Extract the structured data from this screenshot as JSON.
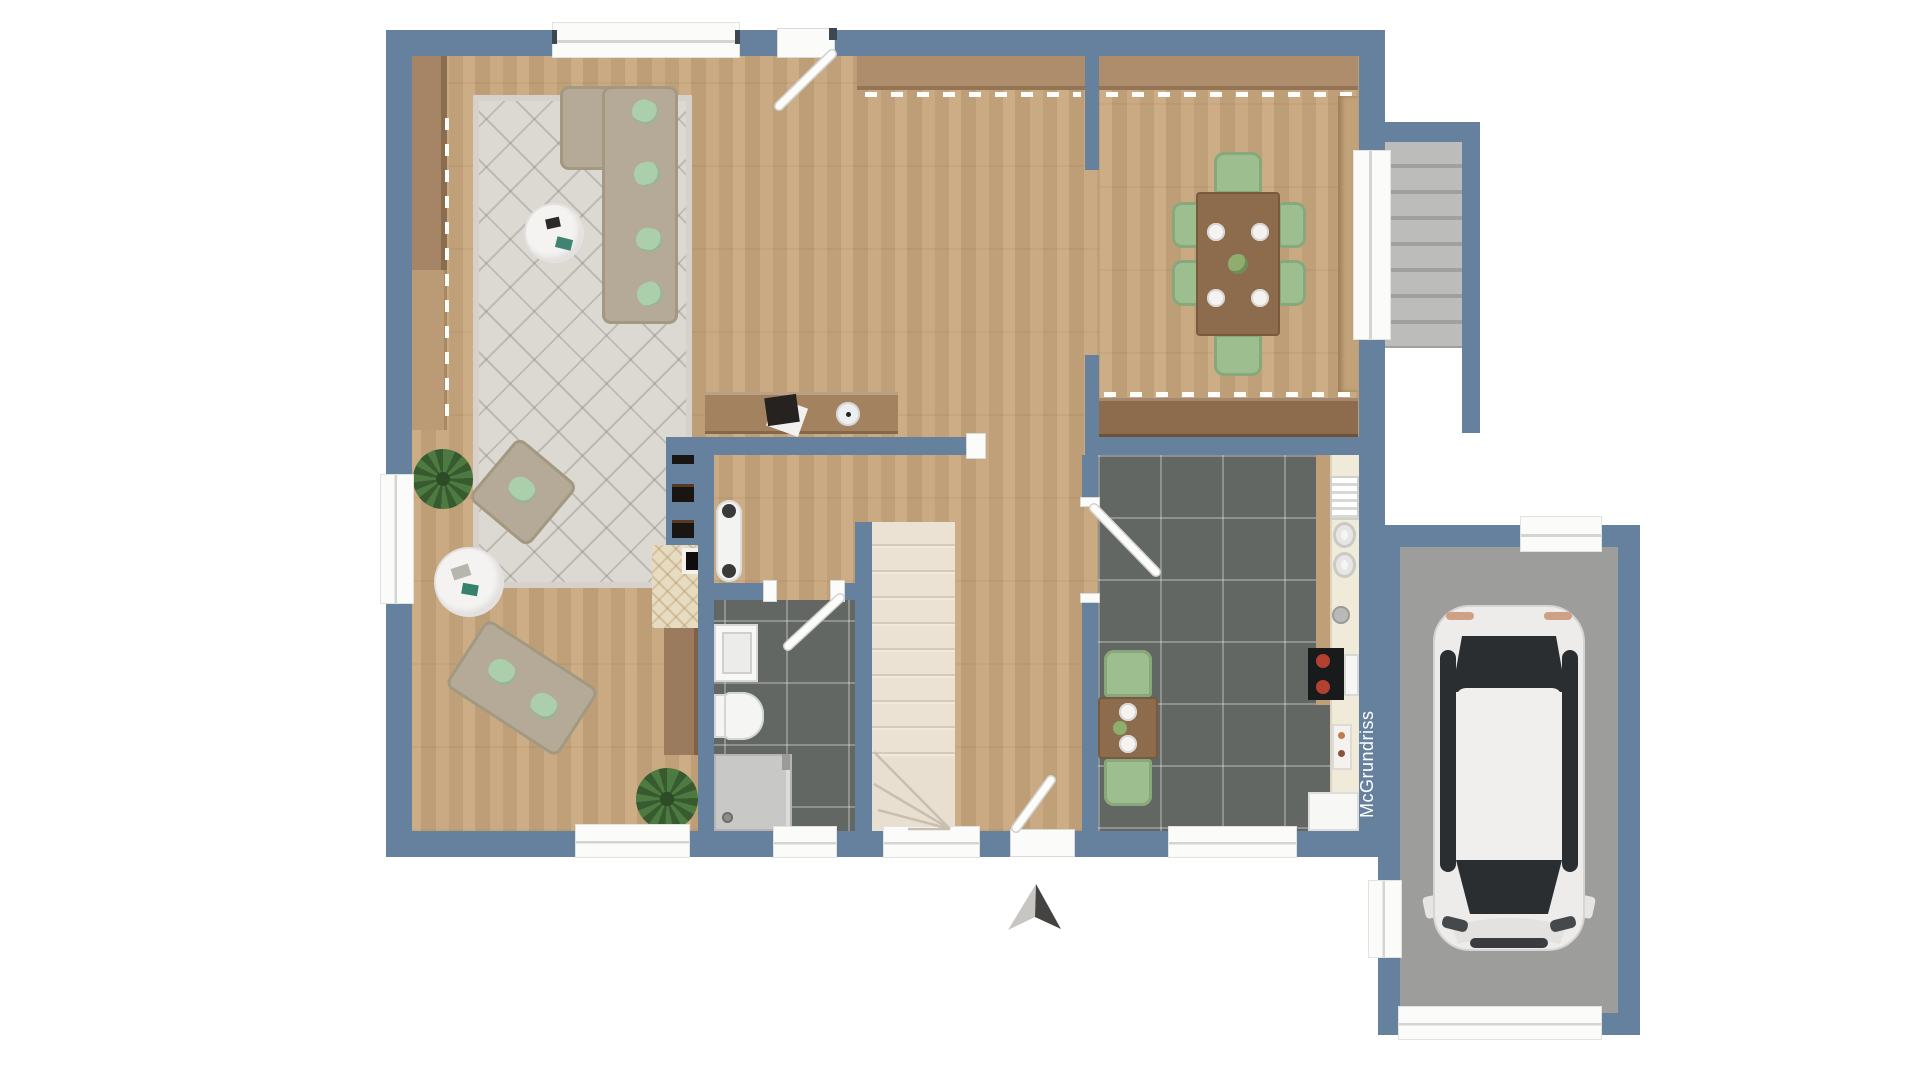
{
  "floorplan": {
    "watermark": "McGrundriss",
    "icons": {
      "north_arrow": "two-tone arrowhead pointing up"
    },
    "palette": {
      "wall": "#66819d",
      "wood": "#c8a77d",
      "tile": "#626763",
      "garage_floor": "#9d9d9b",
      "stair_interior": "#e9dfd1",
      "stair_exterior": "#b4b4b2",
      "rug": "#dcd8d2",
      "sofa": "#b4aa97",
      "pillow": "#accfab",
      "chair": "#9dbf90",
      "table_wood": "#8d6c4e",
      "wardrobe": "#ad8d6b",
      "sideboard": "#a58565",
      "counter": "#f0ead9",
      "fixture_white": "#fbfbfa",
      "car_body": "#edecea",
      "car_glass": "#2b2e31",
      "arrow_light": "#c8c6c3",
      "arrow_dark": "#454341",
      "watermark_text": "#ffffff"
    }
  }
}
